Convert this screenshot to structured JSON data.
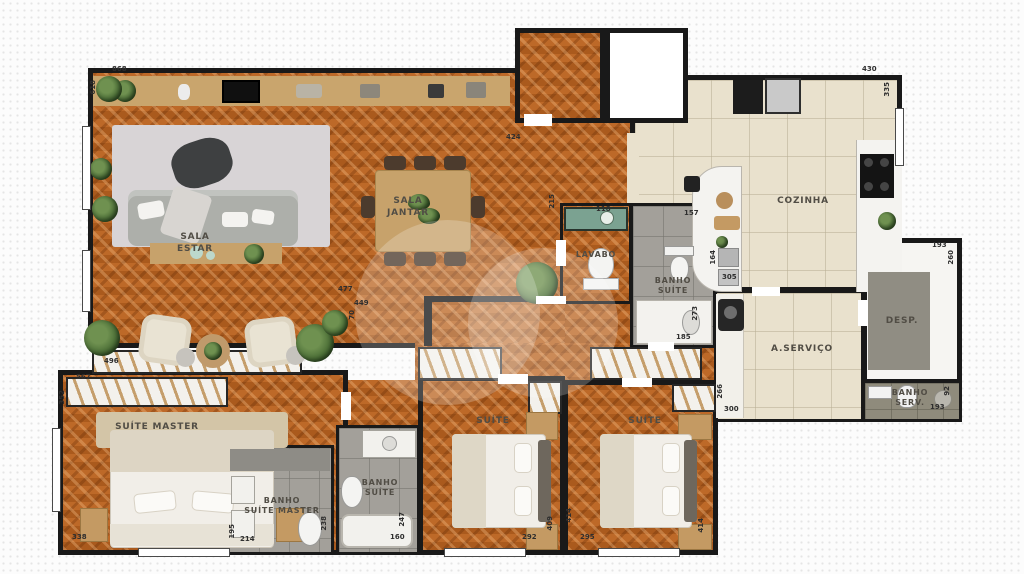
{
  "title": "Apartment floor plan (4 suites)",
  "colors": {
    "wood_floor": "#b2601f",
    "kitchen_tile": "#e9e1cd",
    "bath_tile": "#a3a09a",
    "wall": "#191919",
    "wood_furniture": "#c7a26b",
    "plant_green": "#4a6b35",
    "background": "#fcfcfc"
  },
  "rooms": {
    "sala_estar": {
      "label": "SALA\nESTAR"
    },
    "sala_jantar": {
      "label": "SALA\nJANTAR"
    },
    "lavabo": {
      "label": "LAVABO"
    },
    "banho_suite_hall": {
      "label": "BANHO\nSUÍTE"
    },
    "cozinha": {
      "label": "COZINHA"
    },
    "a_servico": {
      "label": "A.SERVIÇO"
    },
    "desp": {
      "label": "DESP."
    },
    "banho_serv": {
      "label": "BANHO\nSERV."
    },
    "suite_master": {
      "label": "SUÍTE MASTER"
    },
    "banho_suite_master": {
      "label": "BANHO\nSUÍTE MASTER"
    },
    "banho_suite": {
      "label": "BANHO\nSUÍTE"
    },
    "suite_2": {
      "label": "SUÍTE"
    },
    "suite_3": {
      "label": "SUÍTE"
    }
  },
  "dimensions_cm": {
    "living_top": "868",
    "living_left": "618",
    "hall_top": "424",
    "kitchen_top": "430",
    "kitchen_right": "335",
    "lavabo_top": "118",
    "lavabo_left": "215",
    "banho_suite_top": "157",
    "counter_right": "164",
    "counter_bottom": "305",
    "desp_top": "193",
    "desp_right": "260",
    "banho_suite_left": "273",
    "banho_suite_bottom": "185",
    "servico_left": "266",
    "servico_bottom": "300",
    "banho_serv_right": "92",
    "banho_serv_bottom": "193",
    "suite_master_top": "567",
    "suite_master_left": "352",
    "closet_top": "496",
    "sala_bottom": "477",
    "hall_bottom": "449",
    "hall_height": "70",
    "suite_master_bottom": "338",
    "banho_master_left": "195",
    "banho_master_bottom": "214",
    "banho_master_right": "238",
    "banho2_bottom": "160",
    "banho2_right": "247",
    "suite2_bottom": "292",
    "suite2_right": "409",
    "suite3_bottom": "295",
    "suite3_left": "414",
    "suite3_right": "414"
  }
}
